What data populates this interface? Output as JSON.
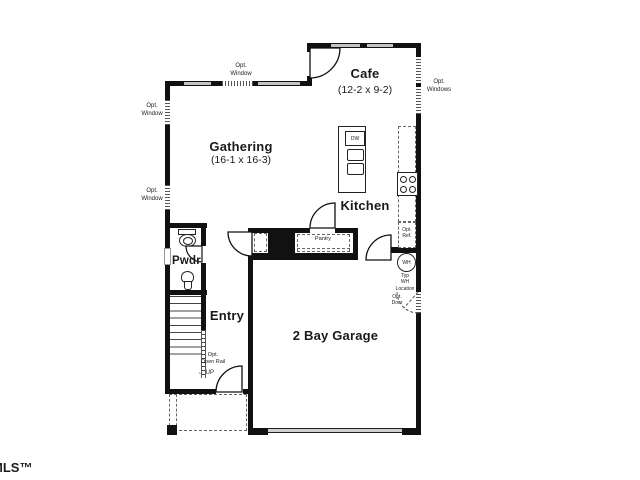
{
  "watermark": "MLS™",
  "rooms": {
    "cafe": {
      "name": "Cafe",
      "dims": "(12-2 x 9-2)"
    },
    "gathering": {
      "name": "Gathering",
      "dims": "(16-1 x 16-3)"
    },
    "kitchen": {
      "name": "Kitchen"
    },
    "pwdr": {
      "name": "Pwdr"
    },
    "entry": {
      "name": "Entry"
    },
    "garage": {
      "name": "2 Bay Garage"
    },
    "pantry": {
      "name": "Pantry"
    }
  },
  "annotations": {
    "opt_window": "Opt.\nWindow",
    "opt_windows": "Opt.\nWindows",
    "opt_ref": "Opt.\nRef.",
    "opt_door": "Opt.\nDoor",
    "typ_wh_location": "Typ\nWH\nLocation",
    "opt_open_rail": "Opt.\nOpen Rail",
    "up": "← UP",
    "wh": "WH",
    "dw": "DW"
  },
  "colors": {
    "wall": "#111111",
    "window_fill": "#c4c4c4",
    "text": "#1a1a1a",
    "background": "#ffffff"
  }
}
